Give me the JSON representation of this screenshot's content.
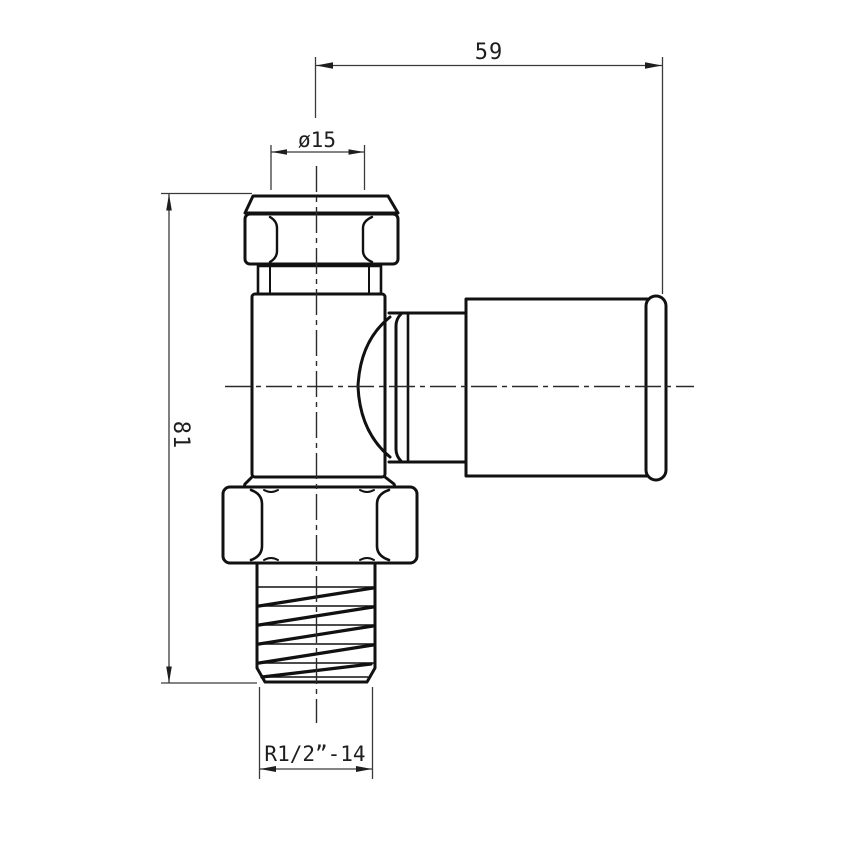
{
  "drawing": {
    "kind": "technical-drawing",
    "subject": "angled compression valve fitting, front elevation",
    "background": "#ffffff",
    "colors": {
      "object_line": "#111111",
      "centerline": "#2a2a2a",
      "dimension_line": "#3a3a3a",
      "text": "#1e1e1e"
    },
    "dimensions": {
      "top_width": {
        "label": "59"
      },
      "pipe_diameter": {
        "label": "ø15"
      },
      "overall_height": {
        "label": "81"
      },
      "thread": {
        "label": "R1/2”-14"
      }
    }
  }
}
